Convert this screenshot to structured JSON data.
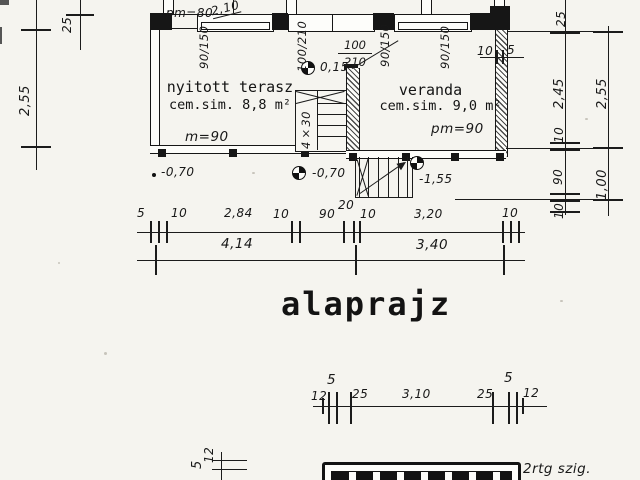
{
  "title": "alaprajz",
  "plan": {
    "rooms": {
      "terrace": {
        "name": "nyitott terasz",
        "finish": "cem.sim. 8,8 m²",
        "note": "m=90"
      },
      "veranda": {
        "name": "veranda",
        "finish": "cem.sim. 9,0 m²",
        "note": "pm=90"
      }
    },
    "openings": {
      "note_pm80": "pm=80",
      "dim_210": "2,10",
      "win_left": "90/150",
      "door_left": "100/210",
      "door_mid_num": "100",
      "door_mid_den": "210",
      "win_mid": "90/150",
      "win_right": "90/150",
      "gap_10": "10",
      "gap_5": "5"
    },
    "stair_label": "4×30",
    "elevations": {
      "e_015": "0,15",
      "e_070a": "-0,70",
      "e_070b": "-0,70",
      "e_155": "-1,55"
    }
  },
  "dims": {
    "left": {
      "top": "25",
      "height": "2,55"
    },
    "right_inner": [
      "25",
      "2,45",
      "10",
      "90",
      "10"
    ],
    "right_outer": [
      "2,55",
      "1,00"
    ],
    "chain_top": [
      "5",
      "10",
      "2,84",
      "10",
      "90",
      "20",
      "10",
      "3,20",
      "10"
    ],
    "chain_total": [
      "4,14",
      "3,40"
    ],
    "chain_bottom": [
      "12",
      "5",
      "25",
      "3,10",
      "25",
      "5",
      "12"
    ],
    "section_left": [
      "5",
      "12"
    ]
  },
  "detail": {
    "note": "2rtg szig."
  }
}
